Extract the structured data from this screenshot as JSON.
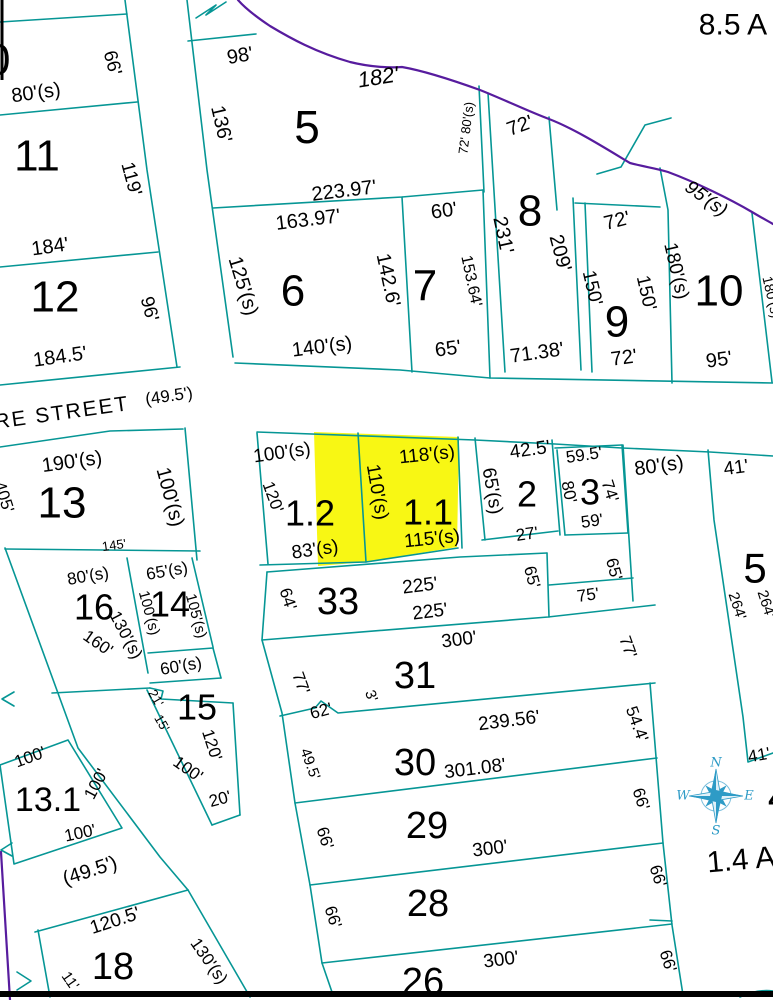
{
  "map": {
    "type": "cadastral-plat-map",
    "acreage_notes": [
      "8.5 A",
      "1.4 A"
    ],
    "street_name": "RE STREET",
    "street_width": "(49.5')",
    "highlighted_parcels": [
      "1.2",
      "1.1"
    ],
    "colors": {
      "parcel_line": "#069695",
      "stream_line": "#571c9e",
      "highlight": "#f8f714",
      "compass": "#2e9bc6",
      "text": "#000000"
    },
    "compass": {
      "n": "N",
      "e": "E",
      "s": "S",
      "w": "W"
    },
    "labels": [
      {
        "t": "10",
        "x": -14,
        "y": 60,
        "s": 44
      },
      {
        "t": "80'(s)",
        "x": 36,
        "y": 93,
        "r": -8,
        "s": 20
      },
      {
        "t": "66'",
        "x": 112,
        "y": 63,
        "r": 75,
        "s": 19
      },
      {
        "t": "11",
        "x": 37,
        "y": 156,
        "s": 44
      },
      {
        "t": "119'",
        "x": 131,
        "y": 179,
        "r": 75,
        "s": 19
      },
      {
        "t": "184'",
        "x": 50,
        "y": 247,
        "r": -8,
        "s": 20
      },
      {
        "t": "12",
        "x": 55,
        "y": 297,
        "s": 44
      },
      {
        "t": "96'",
        "x": 149,
        "y": 309,
        "r": 75,
        "s": 19
      },
      {
        "t": "184.5'",
        "x": 60,
        "y": 357,
        "r": -8,
        "s": 20
      },
      {
        "t": "98'",
        "x": 240,
        "y": 56,
        "r": -10,
        "s": 20
      },
      {
        "t": "136'",
        "x": 221,
        "y": 124,
        "r": 77,
        "s": 20
      },
      {
        "t": "5",
        "x": 307,
        "y": 127,
        "s": 46
      },
      {
        "t": "182'",
        "x": 378,
        "y": 77,
        "r": -9,
        "s": 22,
        "i": true
      },
      {
        "t": "72' 80'(s)",
        "x": 466,
        "y": 128,
        "r": -83,
        "s": 13
      },
      {
        "t": "223.97'",
        "x": 344,
        "y": 191,
        "r": -7,
        "s": 20
      },
      {
        "t": "163.97'",
        "x": 308,
        "y": 220,
        "r": -7,
        "s": 20
      },
      {
        "t": "125'(s)",
        "x": 243,
        "y": 286,
        "r": 73,
        "s": 20
      },
      {
        "t": "6",
        "x": 293,
        "y": 291,
        "s": 44
      },
      {
        "t": "142.6'",
        "x": 388,
        "y": 280,
        "r": 78,
        "s": 20
      },
      {
        "t": "140'(s)",
        "x": 322,
        "y": 347,
        "r": -7,
        "s": 20
      },
      {
        "t": "60'",
        "x": 444,
        "y": 211,
        "r": -8,
        "s": 20
      },
      {
        "t": "7",
        "x": 425,
        "y": 286,
        "s": 44
      },
      {
        "t": "153.64'",
        "x": 471,
        "y": 281,
        "r": 78,
        "s": 16
      },
      {
        "t": "65'",
        "x": 448,
        "y": 349,
        "r": -8,
        "s": 20
      },
      {
        "t": "8.5 A",
        "x": 733,
        "y": 25,
        "s": 30
      },
      {
        "t": "72'",
        "x": 520,
        "y": 126,
        "r": -20,
        "s": 20
      },
      {
        "t": "231'",
        "x": 503,
        "y": 235,
        "r": 78,
        "s": 20
      },
      {
        "t": "8",
        "x": 530,
        "y": 211,
        "s": 44
      },
      {
        "t": "209'",
        "x": 560,
        "y": 253,
        "r": 75,
        "s": 20
      },
      {
        "t": "71.38'",
        "x": 537,
        "y": 353,
        "r": -8,
        "s": 20
      },
      {
        "t": "72'",
        "x": 617,
        "y": 221,
        "r": -14,
        "s": 20
      },
      {
        "t": "150'",
        "x": 592,
        "y": 288,
        "r": 77,
        "s": 19
      },
      {
        "t": "9",
        "x": 617,
        "y": 322,
        "s": 44
      },
      {
        "t": "150'",
        "x": 646,
        "y": 293,
        "r": 77,
        "s": 19
      },
      {
        "t": "72'",
        "x": 624,
        "y": 358,
        "r": -8,
        "s": 20
      },
      {
        "t": "95'(s)",
        "x": 706,
        "y": 199,
        "r": 36,
        "s": 19,
        "i": true
      },
      {
        "t": "180'(s)",
        "x": 676,
        "y": 271,
        "r": 77,
        "s": 19
      },
      {
        "t": "10",
        "x": 719,
        "y": 291,
        "s": 44
      },
      {
        "t": "95'",
        "x": 719,
        "y": 360,
        "r": -8,
        "s": 20
      },
      {
        "t": "180'(s)",
        "x": 772,
        "y": 297,
        "r": 77,
        "s": 14
      },
      {
        "t": "RE STREET",
        "x": 62,
        "y": 413,
        "r": -8,
        "s": 21,
        "ls": 2
      },
      {
        "t": "(49.5')",
        "x": 169,
        "y": 396,
        "r": -8,
        "s": 17
      },
      {
        "t": "190'(s)",
        "x": 72,
        "y": 462,
        "r": -8,
        "s": 20
      },
      {
        "t": "13",
        "x": 62,
        "y": 503,
        "s": 44
      },
      {
        "t": "100'(s)",
        "x": 170,
        "y": 497,
        "r": 75,
        "s": 20
      },
      {
        "t": "405'",
        "x": 4,
        "y": 497,
        "r": 72,
        "s": 17
      },
      {
        "t": "145'",
        "x": 114,
        "y": 545,
        "r": -8,
        "s": 13
      },
      {
        "t": "100'(s)",
        "x": 282,
        "y": 453,
        "r": -8,
        "s": 19
      },
      {
        "t": "120'",
        "x": 273,
        "y": 497,
        "r": 70,
        "s": 17
      },
      {
        "t": "1.2",
        "x": 310,
        "y": 513,
        "s": 36
      },
      {
        "t": "83'(s)",
        "x": 315,
        "y": 550,
        "r": -8,
        "s": 19
      },
      {
        "t": "110'(s)",
        "x": 377,
        "y": 492,
        "r": 80,
        "s": 19
      },
      {
        "t": "118'(s)",
        "x": 427,
        "y": 455,
        "r": -6,
        "s": 19
      },
      {
        "t": "1.1",
        "x": 428,
        "y": 512,
        "s": 36
      },
      {
        "t": "115'(s)",
        "x": 432,
        "y": 539,
        "r": -6,
        "s": 19
      },
      {
        "t": "65'(s)",
        "x": 492,
        "y": 491,
        "r": 80,
        "s": 19
      },
      {
        "t": "42.5'",
        "x": 530,
        "y": 450,
        "r": -8,
        "s": 19
      },
      {
        "t": "2",
        "x": 527,
        "y": 494,
        "s": 36
      },
      {
        "t": "27'",
        "x": 527,
        "y": 534,
        "r": -8,
        "s": 17
      },
      {
        "t": "59.5'",
        "x": 584,
        "y": 455,
        "r": -8,
        "s": 17
      },
      {
        "t": "80'",
        "x": 569,
        "y": 492,
        "r": 78,
        "s": 17
      },
      {
        "t": "3",
        "x": 590,
        "y": 492,
        "s": 36
      },
      {
        "t": "74'",
        "x": 610,
        "y": 491,
        "r": 72,
        "s": 17
      },
      {
        "t": "59'",
        "x": 592,
        "y": 521,
        "r": -8,
        "s": 17
      },
      {
        "t": "80'(s)",
        "x": 659,
        "y": 466,
        "r": -8,
        "s": 20
      },
      {
        "t": "41'",
        "x": 736,
        "y": 468,
        "r": -8,
        "s": 19
      },
      {
        "t": "5",
        "x": 755,
        "y": 568,
        "s": 42
      },
      {
        "t": "264'",
        "x": 737,
        "y": 606,
        "r": 72,
        "s": 15
      },
      {
        "t": "264'",
        "x": 766,
        "y": 604,
        "r": 72,
        "s": 15
      },
      {
        "t": "80'(s)",
        "x": 88,
        "y": 576,
        "r": -10,
        "s": 17
      },
      {
        "t": "16",
        "x": 94,
        "y": 607,
        "s": 36
      },
      {
        "t": "130'(s)",
        "x": 126,
        "y": 635,
        "r": 62,
        "s": 17
      },
      {
        "t": "160'",
        "x": 98,
        "y": 643,
        "r": 35,
        "s": 17
      },
      {
        "t": "65'(s)",
        "x": 167,
        "y": 571,
        "r": -10,
        "s": 17
      },
      {
        "t": "100'(s)",
        "x": 149,
        "y": 613,
        "r": 75,
        "s": 15
      },
      {
        "t": "14",
        "x": 170,
        "y": 604,
        "s": 36
      },
      {
        "t": "105'(s)",
        "x": 196,
        "y": 616,
        "r": 75,
        "s": 15
      },
      {
        "t": "60'(s)",
        "x": 181,
        "y": 666,
        "r": -10,
        "s": 17
      },
      {
        "t": "21'",
        "x": 156,
        "y": 698,
        "r": 60,
        "s": 13
      },
      {
        "t": "15'",
        "x": 162,
        "y": 723,
        "r": 60,
        "s": 13
      },
      {
        "t": "15",
        "x": 197,
        "y": 707,
        "s": 36
      },
      {
        "t": "120'",
        "x": 212,
        "y": 745,
        "r": 72,
        "s": 17
      },
      {
        "t": "100'",
        "x": 188,
        "y": 769,
        "r": 35,
        "s": 17
      },
      {
        "t": "20'",
        "x": 220,
        "y": 799,
        "r": -15,
        "s": 17
      },
      {
        "t": "100'",
        "x": 30,
        "y": 757,
        "r": -20,
        "s": 17
      },
      {
        "t": "13.1",
        "x": 48,
        "y": 800,
        "s": 34
      },
      {
        "t": "100'",
        "x": 96,
        "y": 784,
        "r": -62,
        "s": 17
      },
      {
        "t": "100'",
        "x": 80,
        "y": 833,
        "r": -12,
        "s": 17
      },
      {
        "t": "(49.5')",
        "x": 90,
        "y": 871,
        "r": -18,
        "s": 20
      },
      {
        "t": "120.5'",
        "x": 115,
        "y": 921,
        "r": -18,
        "s": 19
      },
      {
        "t": "11'",
        "x": 70,
        "y": 981,
        "r": 55,
        "s": 15
      },
      {
        "t": "18",
        "x": 113,
        "y": 967,
        "s": 38
      },
      {
        "t": "130'(s)",
        "x": 209,
        "y": 961,
        "r": 55,
        "s": 17
      },
      {
        "t": "64'",
        "x": 288,
        "y": 599,
        "r": 72,
        "s": 17
      },
      {
        "t": "33",
        "x": 338,
        "y": 602,
        "s": 38
      },
      {
        "t": "225'",
        "x": 420,
        "y": 586,
        "r": -7,
        "s": 19
      },
      {
        "t": "225'",
        "x": 430,
        "y": 612,
        "r": -7,
        "s": 19
      },
      {
        "t": "65'",
        "x": 532,
        "y": 577,
        "r": 75,
        "s": 17
      },
      {
        "t": "75'",
        "x": 588,
        "y": 595,
        "r": -8,
        "s": 17
      },
      {
        "t": "65'",
        "x": 614,
        "y": 569,
        "r": 75,
        "s": 17
      },
      {
        "t": "300'",
        "x": 459,
        "y": 640,
        "r": -7,
        "s": 19
      },
      {
        "t": "31",
        "x": 415,
        "y": 676,
        "s": 38
      },
      {
        "t": "77'",
        "x": 301,
        "y": 683,
        "r": 70,
        "s": 17
      },
      {
        "t": "3'",
        "x": 371,
        "y": 696,
        "r": 70,
        "s": 15
      },
      {
        "t": "62'",
        "x": 321,
        "y": 711,
        "r": -15,
        "s": 17
      },
      {
        "t": "77'",
        "x": 628,
        "y": 647,
        "r": 70,
        "s": 17
      },
      {
        "t": "239.56'",
        "x": 509,
        "y": 721,
        "r": -7,
        "s": 19
      },
      {
        "t": "30",
        "x": 415,
        "y": 763,
        "s": 38
      },
      {
        "t": "49.5'",
        "x": 310,
        "y": 764,
        "r": 70,
        "s": 15
      },
      {
        "t": "301.08'",
        "x": 475,
        "y": 769,
        "r": -7,
        "s": 19
      },
      {
        "t": "54.4'",
        "x": 637,
        "y": 724,
        "r": 70,
        "s": 17
      },
      {
        "t": "66'",
        "x": 325,
        "y": 838,
        "r": 72,
        "s": 17
      },
      {
        "t": "29",
        "x": 427,
        "y": 826,
        "s": 38
      },
      {
        "t": "300'",
        "x": 490,
        "y": 849,
        "r": -7,
        "s": 19
      },
      {
        "t": "66'",
        "x": 641,
        "y": 799,
        "r": 72,
        "s": 17
      },
      {
        "t": "66'",
        "x": 333,
        "y": 917,
        "r": 72,
        "s": 17
      },
      {
        "t": "28",
        "x": 428,
        "y": 904,
        "s": 38
      },
      {
        "t": "66'",
        "x": 658,
        "y": 876,
        "r": 72,
        "s": 17
      },
      {
        "t": "26",
        "x": 423,
        "y": 982,
        "s": 38
      },
      {
        "t": "300'",
        "x": 501,
        "y": 960,
        "r": -7,
        "s": 19
      },
      {
        "t": "66'",
        "x": 668,
        "y": 961,
        "r": 72,
        "s": 17
      },
      {
        "t": "41'",
        "x": 759,
        "y": 755,
        "r": -10,
        "s": 17
      },
      {
        "t": "1.4 A",
        "x": 741,
        "y": 860,
        "r": -5,
        "s": 30
      },
      {
        "t": "4",
        "x": 780,
        "y": 797,
        "s": 44
      }
    ]
  }
}
